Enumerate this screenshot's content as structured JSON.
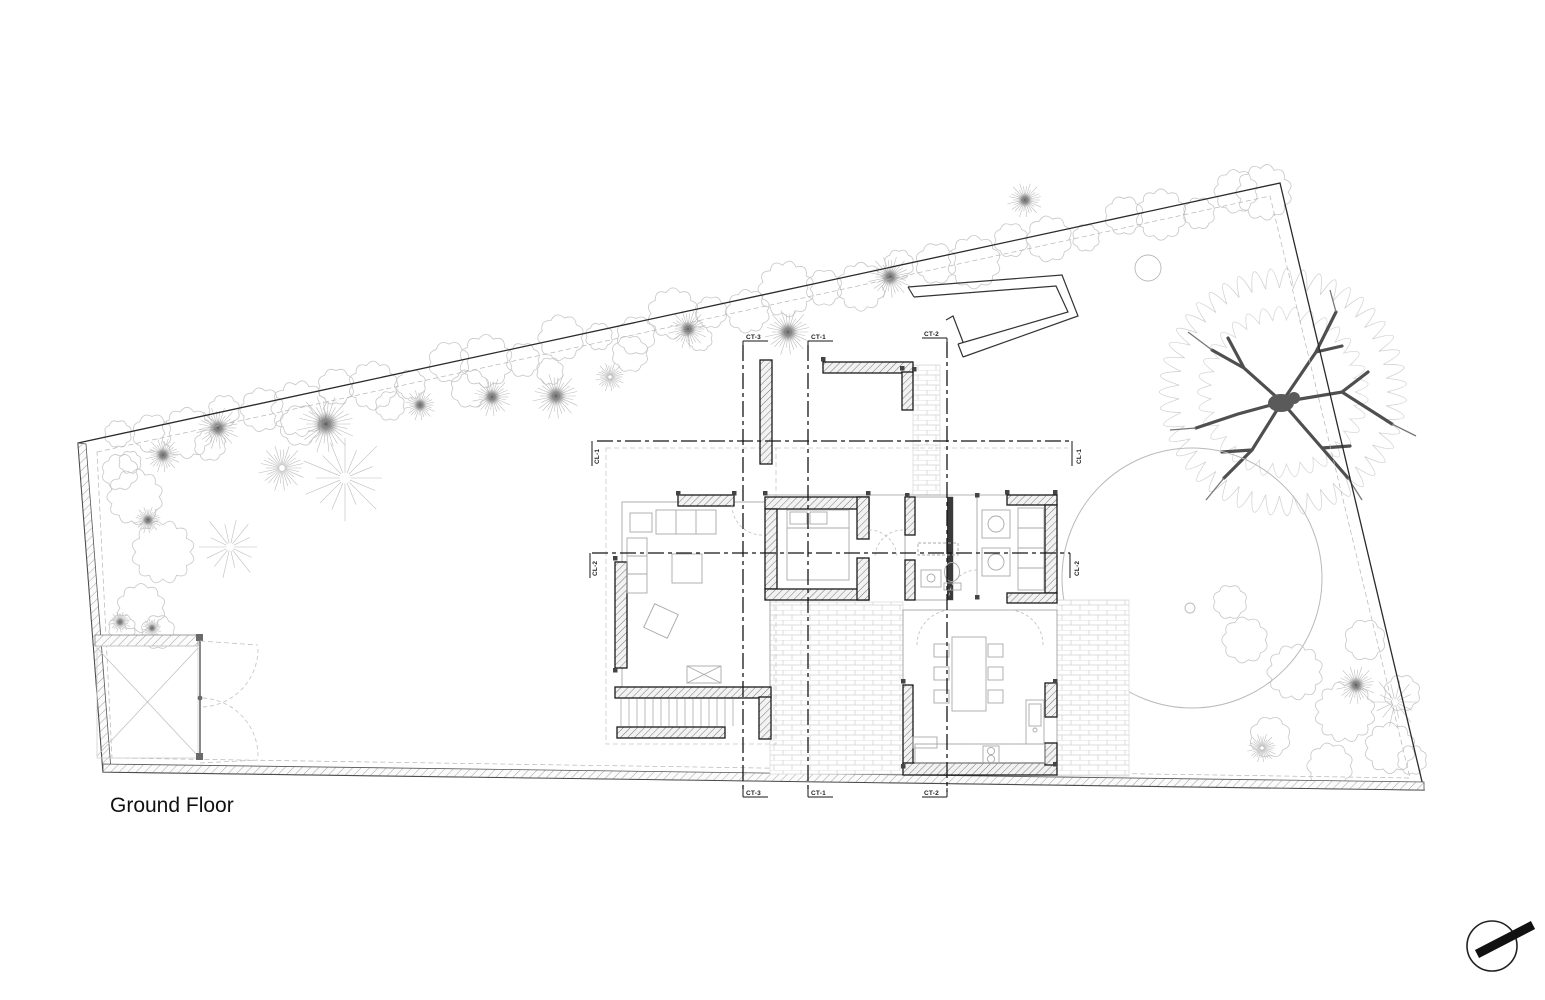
{
  "drawing": {
    "title": "Ground Floor",
    "markers": {
      "ct1": "CT-1",
      "ct2": "CT-2",
      "ct3": "CT-3",
      "cl1": "CL-1",
      "cl2": "CL-2"
    },
    "colors": {
      "paper": "#ffffff",
      "ink": "#1a1a1a",
      "light_line": "#bdbdbd",
      "wall_hatch": "#777777"
    }
  }
}
